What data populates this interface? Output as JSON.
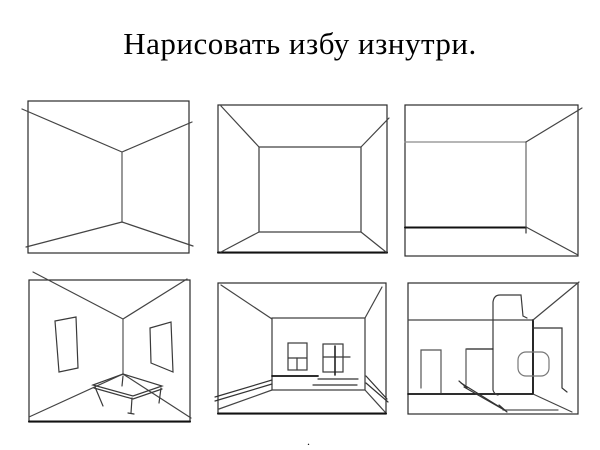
{
  "slide": {
    "title": "Нарисовать избу изнутри.",
    "dot": "."
  },
  "colors": {
    "background": "#ffffff",
    "ink": "#222222",
    "ink_dark": "#111111",
    "ink_light": "#8a8a8a"
  },
  "panels": [
    {
      "name": "corner-view-empty-room"
    },
    {
      "name": "one-point-perspective-centered"
    },
    {
      "name": "one-point-perspective-left-wall"
    },
    {
      "name": "corner-room-with-pictures-and-table"
    },
    {
      "name": "room-with-windows-and-bench"
    },
    {
      "name": "room-with-stove-and-door"
    }
  ]
}
